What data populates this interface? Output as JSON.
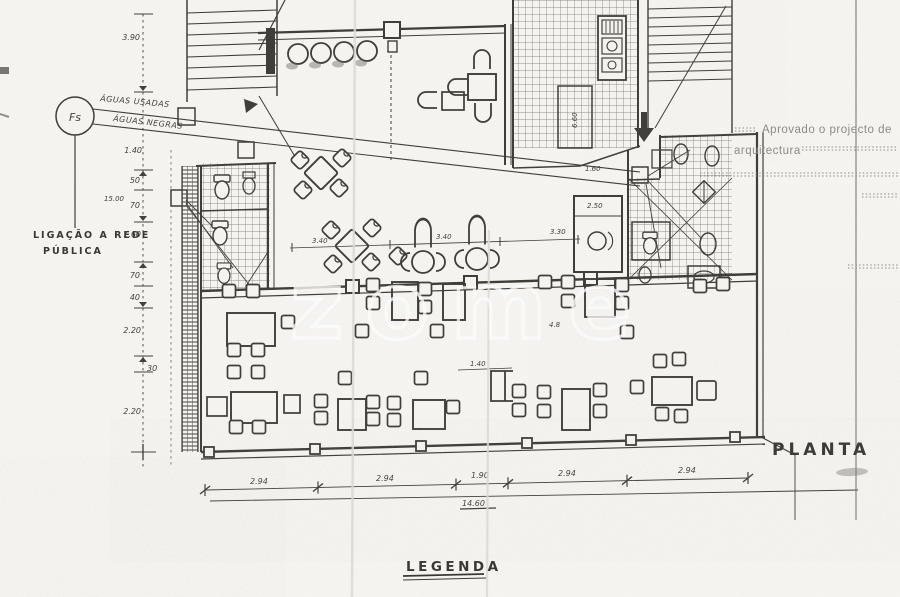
{
  "stamp": {
    "line1": "Aprovado o projecto de",
    "line2": "arquitectura"
  },
  "titles": {
    "plan": "PLANTA",
    "legend": "LEGENDA"
  },
  "watermark": "zome",
  "utility": {
    "node": "Fs",
    "pipe_top": "ÁGUAS USADAS",
    "pipe_bottom": "ÁGUAS NEGRAS",
    "connection1": "LIGAÇÃO A REDE",
    "connection2": "PÚBLICA"
  },
  "dimensions": {
    "left": {
      "segments": [
        "3.90",
        "1.40",
        "50",
        "70",
        "1.60",
        "70",
        "40",
        "2.20",
        "30",
        "2.20"
      ],
      "total": "15.00"
    },
    "bottom": {
      "segments": [
        "2.94",
        "2.94",
        "1.90",
        "2.94",
        "2.94"
      ],
      "total": "14.60"
    },
    "interior": {
      "d1": "3.40",
      "d2": "3.40",
      "d3": "3.30",
      "d4": "1.60",
      "d5": "2.50",
      "d6": "1.40",
      "d7": "4.8",
      "d8": "6.60"
    }
  },
  "colors": {
    "paper": "#f7f6f2",
    "ink": "#3a3833",
    "stamp_gray": "#8b8985"
  }
}
